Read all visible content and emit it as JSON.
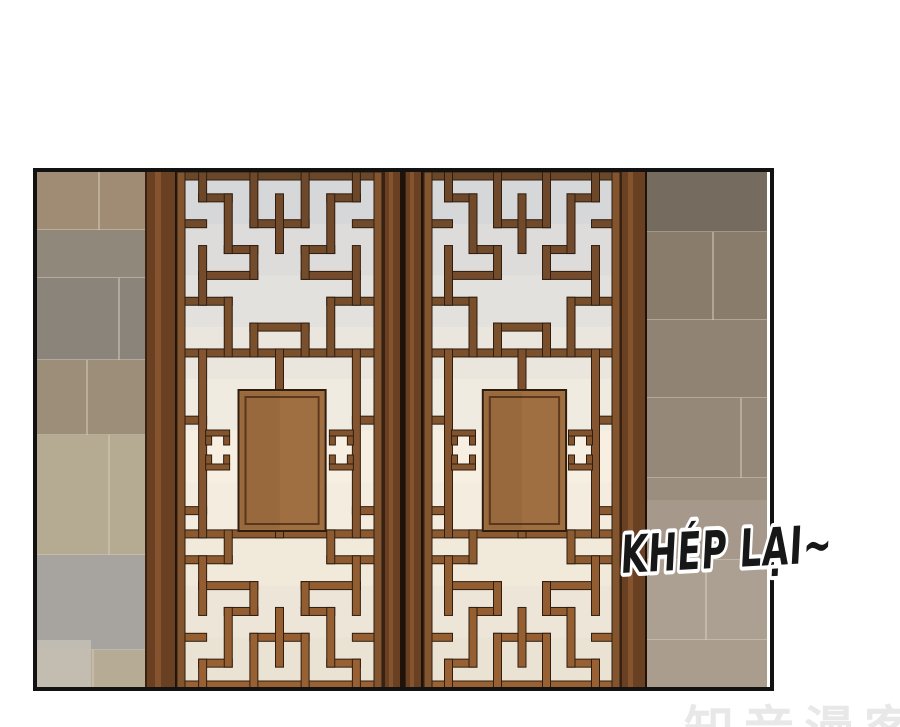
{
  "scene": {
    "speech_text": "KHÉP LẠI~",
    "watermark_text": "知音漫客"
  },
  "colors": {
    "page_bg": "#ffffff",
    "panel_border": "#121212",
    "wood_frame": "#6a4023",
    "wood_frame_light": "#885631",
    "wood_frame_dark": "#3a2112",
    "wood_seam": "#1f1208",
    "lattice_top": "#6b4729",
    "lattice_bottom": "#9a6233",
    "lattice_outline": "#2f1d10",
    "door_board": "#a06f41",
    "door_board_line": "#5d3a1e",
    "door_bg_top": "#d6d7d9",
    "door_bg_glow": "#f7f0e2",
    "door_bg_bottom": "#eae3d4",
    "wall_left_tones": [
      "#a08c74",
      "#91887c",
      "#8b847a",
      "#9c8e79",
      "#b5aa92",
      "#a7a39e",
      "#b6ab94"
    ],
    "wall_right_tones": [
      "#7e7265",
      "#897c6b",
      "#908373",
      "#968879",
      "#9c8e7e",
      "#a39686",
      "#aa9d8d"
    ],
    "wall_joint": "#d2c9b6",
    "speech_fill": "#171717",
    "speech_outline": "#ffffff",
    "watermark_color": "#dcdcdc"
  }
}
